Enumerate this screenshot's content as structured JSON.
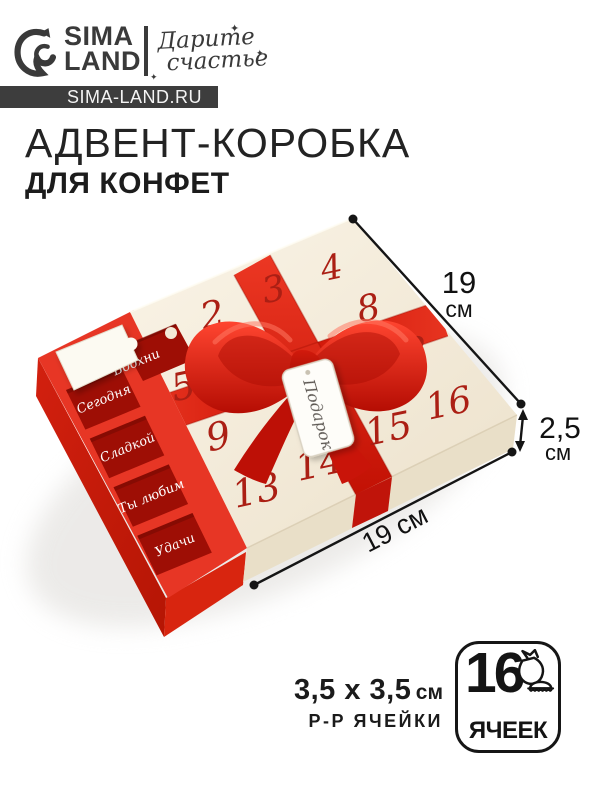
{
  "header": {
    "brand_line1": "SIMA",
    "brand_line2": "LAND",
    "tagline_line1": "Дарите",
    "tagline_line2": "счастье",
    "sparkle_glyph": "✦",
    "site_badge": "SIMA-LAND.RU"
  },
  "title": {
    "line1": "АДВЕНТ-КОРОБКА",
    "line2": "ДЛЯ КОНФЕТ"
  },
  "box": {
    "numbers": [
      "2",
      "3",
      "4",
      "5",
      "8",
      "9",
      "12",
      "13",
      "14",
      "15",
      "16"
    ],
    "cells": [
      "Сегодня",
      "Сладкой",
      "Ты любим",
      "Удачи"
    ],
    "window_text": "Вдохни",
    "tag_text": "Подарок"
  },
  "dimensions": {
    "side_value": "19",
    "side_unit": "см",
    "height_value": "2,5",
    "height_unit": "см",
    "front_label": "19 см"
  },
  "footer": {
    "cell_size": "3,5 х 3,5",
    "cell_size_unit": "см",
    "cell_size_caption": "Р-Р ЯЧЕЙКИ",
    "count": "16",
    "count_caption": "ЯЧЕЕК"
  },
  "colors": {
    "accent_red": "#e2271b",
    "deep_red": "#9e0e05",
    "cream": "#f3ecdc",
    "ink": "#161616",
    "badge_bg": "#3d3d3d"
  }
}
